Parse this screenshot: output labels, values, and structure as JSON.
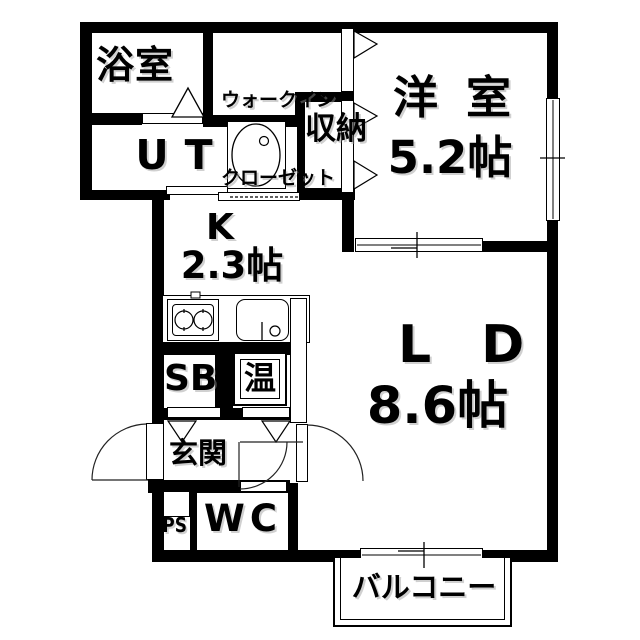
{
  "title": "apartment-floorplan",
  "rooms": {
    "bathroom": {
      "label": "浴室"
    },
    "walkin_closet": {
      "label_line1": "ウォークイン",
      "label_line2": "クローゼット"
    },
    "western_room": {
      "label": "洋室",
      "size": "5.2帖"
    },
    "utility": {
      "label": "UT"
    },
    "storage": {
      "label": "収納"
    },
    "kitchen": {
      "label": "K",
      "size": "2.3帖"
    },
    "living_dining": {
      "label": "LD",
      "size": "8.6帖"
    },
    "shoe_box": {
      "label": "SB"
    },
    "water_heater": {
      "label": "温"
    },
    "entrance": {
      "label": "玄関"
    },
    "pipe_space": {
      "label": "PS"
    },
    "toilet": {
      "label": "WC"
    },
    "balcony": {
      "label": "バルコニー"
    }
  },
  "colors": {
    "wall": "#000000",
    "background": "#ffffff",
    "line": "#222222"
  }
}
